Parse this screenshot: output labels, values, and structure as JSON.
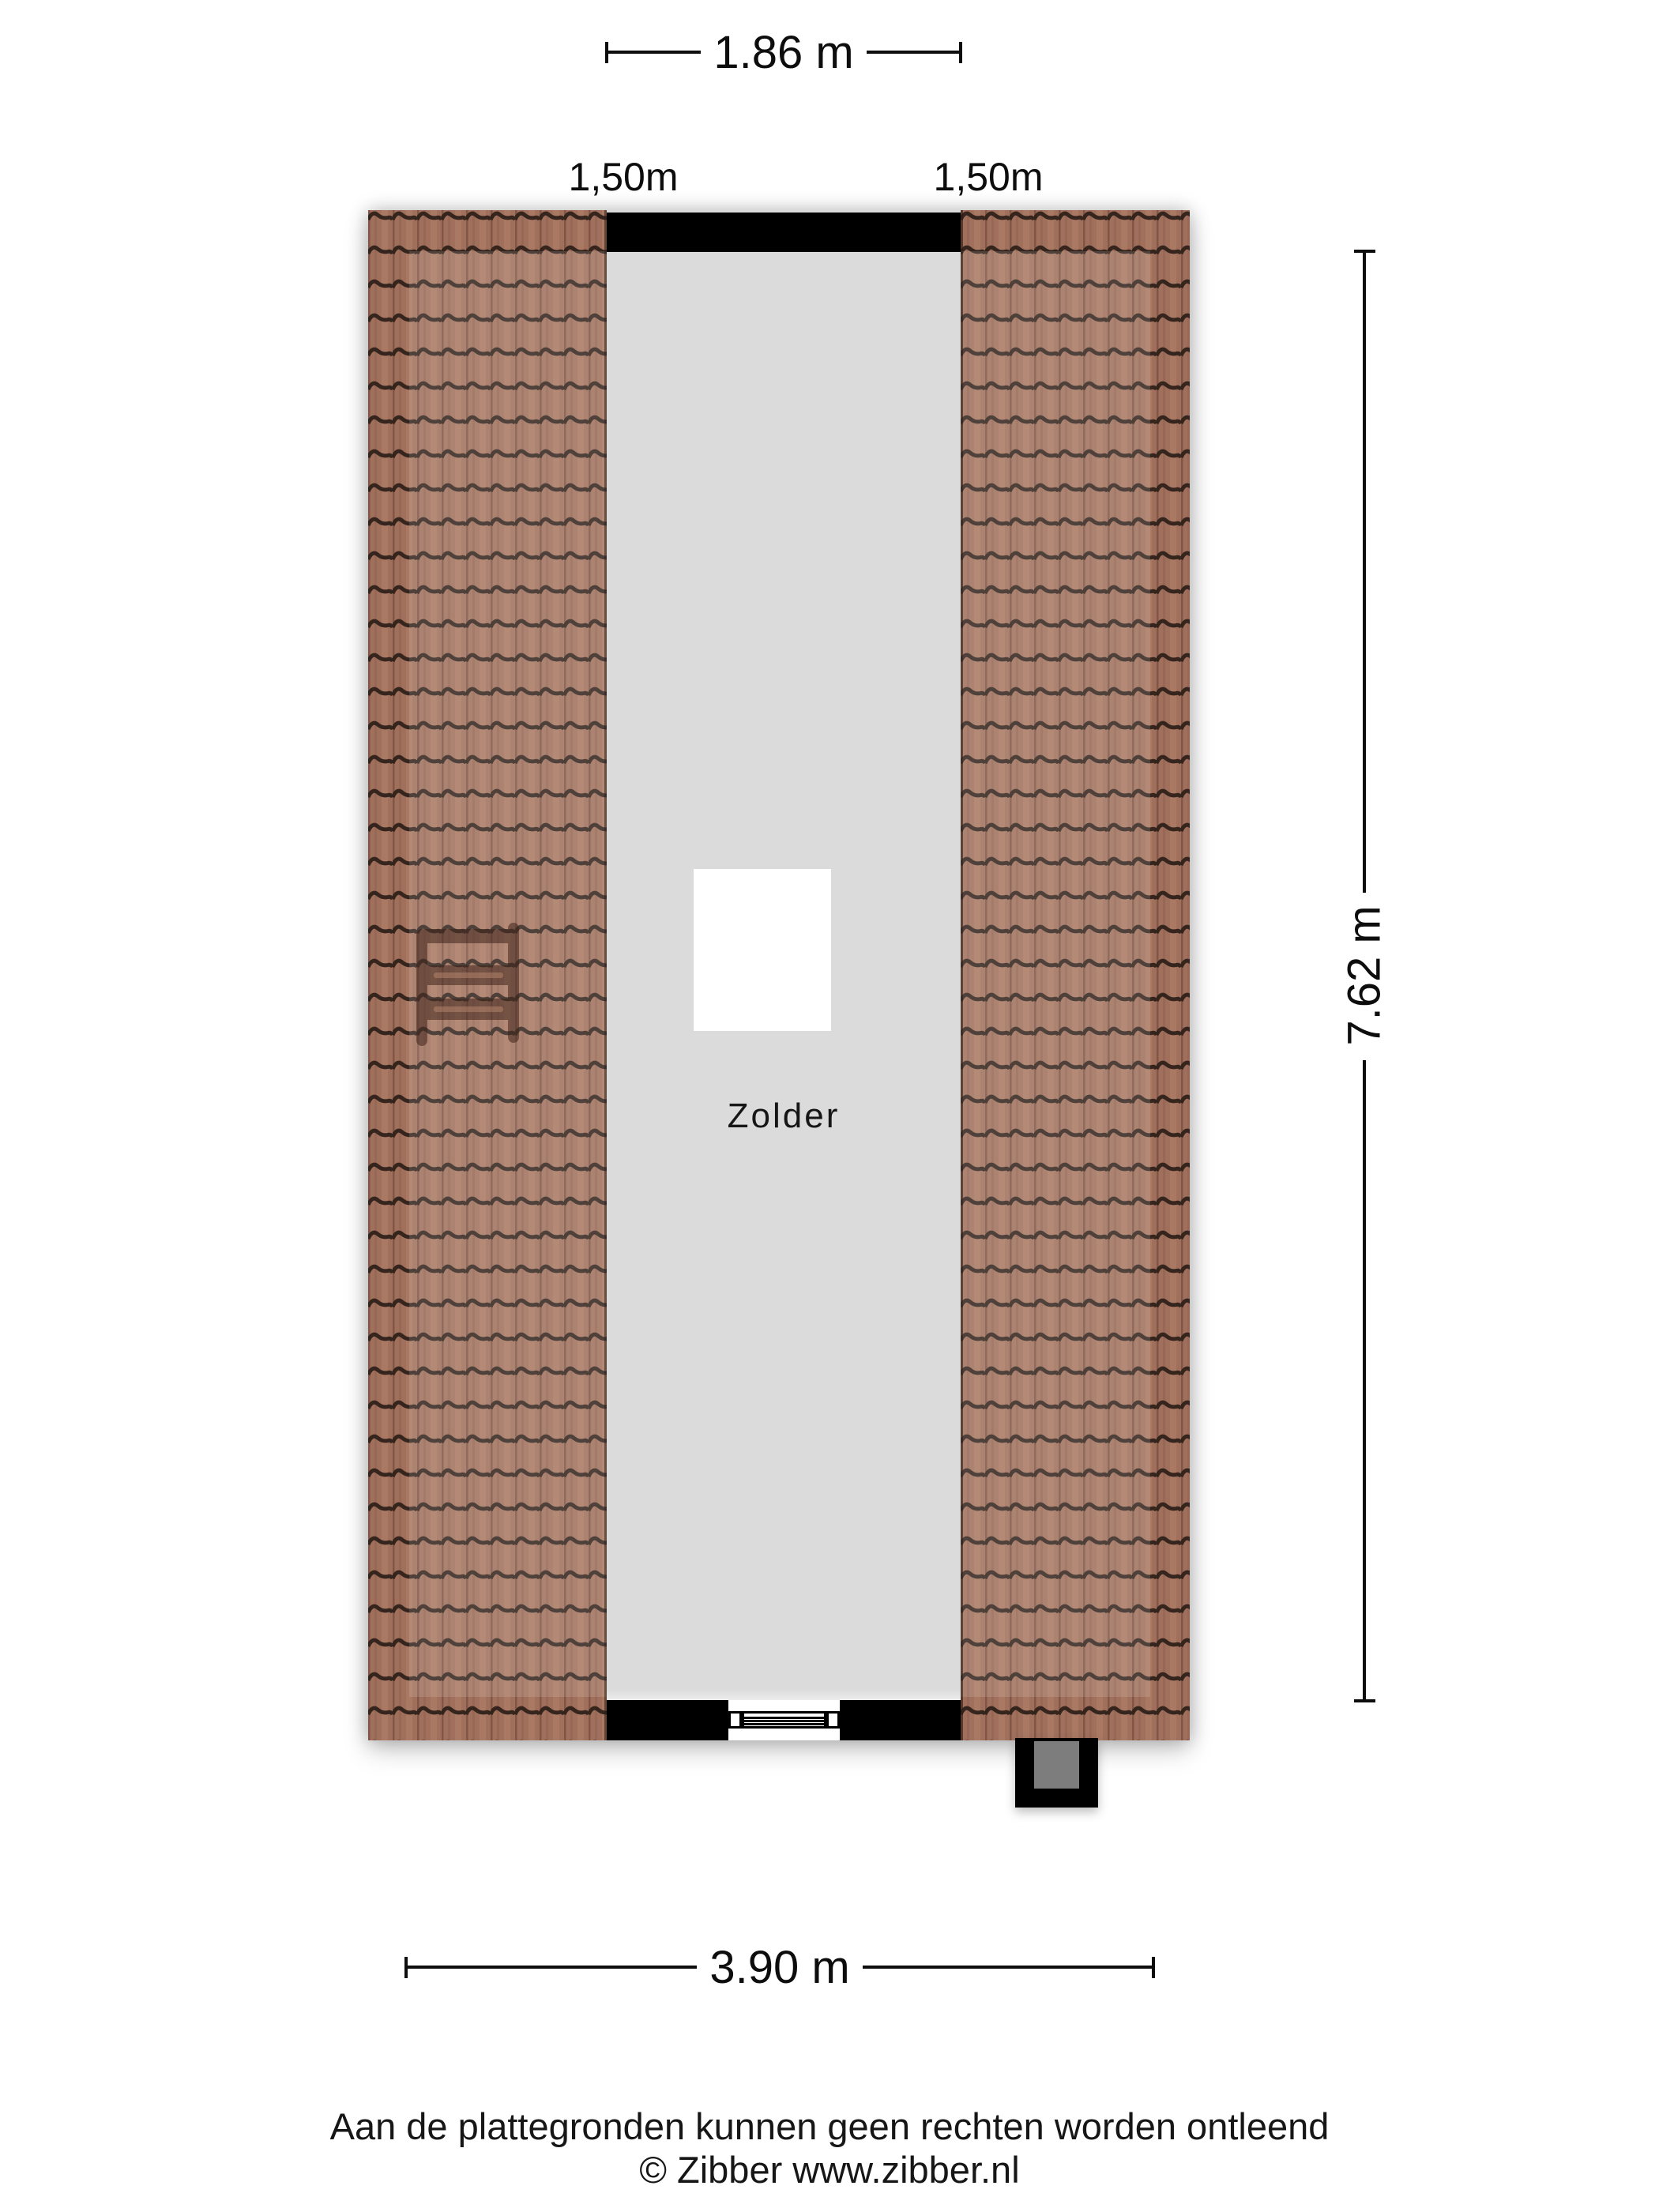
{
  "plan": {
    "room_label": "Zolder",
    "colors": {
      "tile": "#a0705c",
      "tile_dark_line": "#2b1e18",
      "tile_shadow_strip": "#7c5142",
      "interior_gray": "#dbdbdb",
      "wall_black": "#000000",
      "chimney_inner_gray": "#7d7d7d",
      "skylight_white": "#ffffff"
    }
  },
  "dimensions": {
    "top": {
      "label": "1.86 m"
    },
    "roof_left": {
      "label": "1,50m"
    },
    "roof_right": {
      "label": "1,50m"
    },
    "right": {
      "label": "7.62 m"
    },
    "bottom": {
      "label": "3.90 m"
    }
  },
  "footer": {
    "disclaimer": "Aan de plattegronden kunnen geen rechten worden ontleend",
    "copyright": "© Zibber www.zibber.nl"
  }
}
